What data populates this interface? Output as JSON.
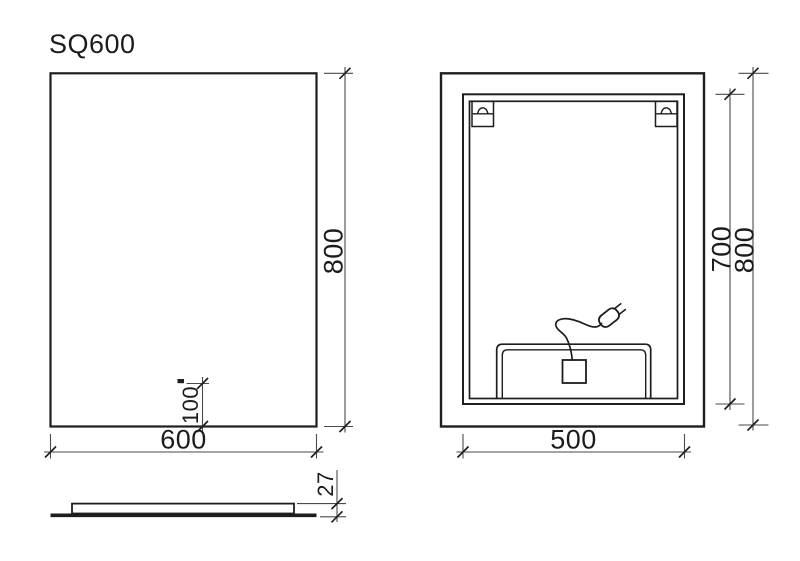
{
  "title": "SQ600",
  "front_view": {
    "width_mm": "600",
    "height_mm": "800",
    "sensor_offset_mm": "100"
  },
  "back_view": {
    "frame_width_mm": "500",
    "frame_height_mm": "700",
    "height_mm": "800"
  },
  "side_view": {
    "thickness_mm": "27"
  },
  "colors": {
    "background": "#ffffff",
    "object_line": "#1e1e1e",
    "dimension_line": "#4a4a4a",
    "text": "#1c1c1c"
  }
}
